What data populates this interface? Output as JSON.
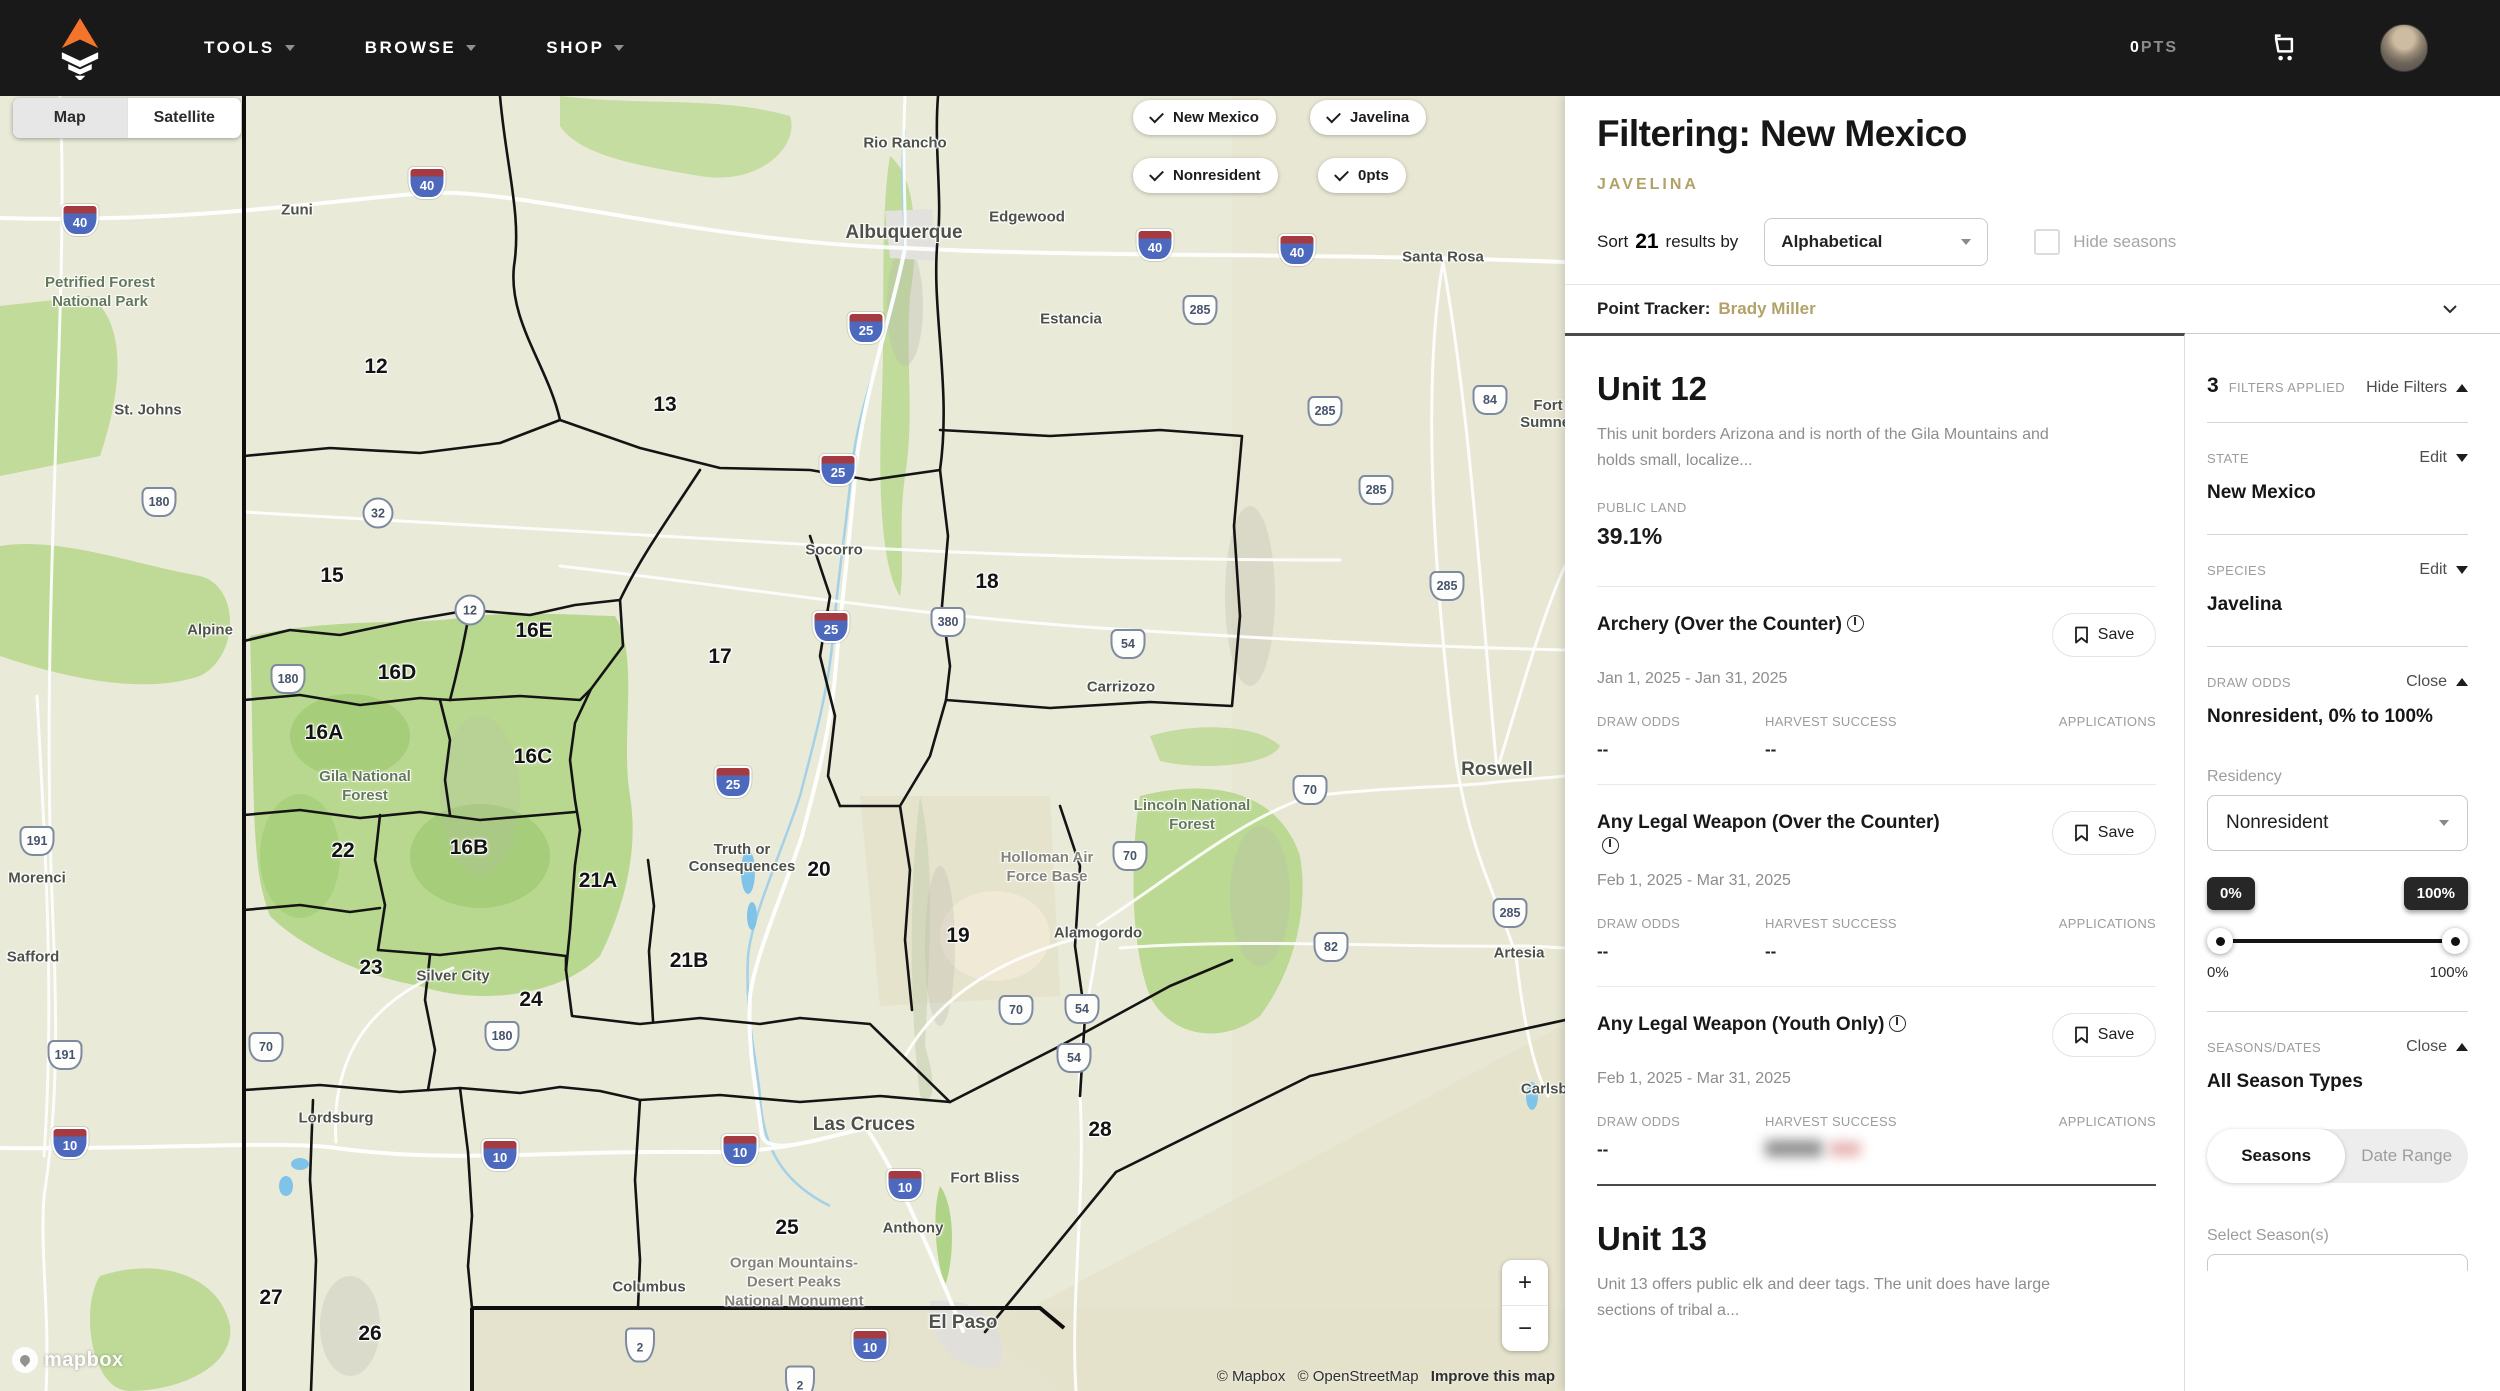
{
  "nav": {
    "menus": [
      {
        "label": "TOOLS"
      },
      {
        "label": "BROWSE"
      },
      {
        "label": "SHOP"
      }
    ],
    "points_value": "0",
    "points_label": "PTS"
  },
  "map": {
    "style_toggle": {
      "map": "Map",
      "satellite": "Satellite"
    },
    "chips": [
      {
        "label": "New Mexico"
      },
      {
        "label": "Javelina"
      },
      {
        "label": "Nonresident"
      },
      {
        "label": "0pts"
      }
    ],
    "zoom": {
      "in": "+",
      "out": "−"
    },
    "logo_text": "mapbox",
    "attribution": {
      "mapbox": "© Mapbox",
      "osm": "© OpenStreetMap",
      "improve": "Improve this map"
    },
    "cities": [
      {
        "label": "Zuni",
        "x": 297,
        "y": 114
      },
      {
        "label": "St. Johns",
        "x": 148,
        "y": 314
      },
      {
        "label": "Alpine",
        "x": 210,
        "y": 534
      },
      {
        "label": "Rio Rancho",
        "x": 905,
        "y": 47
      },
      {
        "label": "Albuquerque",
        "x": 904,
        "y": 137,
        "size": "lg"
      },
      {
        "label": "Edgewood",
        "x": 1027,
        "y": 121
      },
      {
        "label": "Estancia",
        "x": 1071,
        "y": 223
      },
      {
        "label": "Santa Rosa",
        "x": 1443,
        "y": 161
      },
      {
        "label": "Fort Sumner",
        "x": 1548,
        "y": 318
      },
      {
        "label": "Socorro",
        "x": 834,
        "y": 454
      },
      {
        "label": "Carrizozo",
        "x": 1121,
        "y": 591
      },
      {
        "label": "Roswell",
        "x": 1497,
        "y": 674,
        "size": "lg"
      },
      {
        "label": "Truth or\nConsequences",
        "x": 742,
        "y": 762
      },
      {
        "label": "Alamogordo",
        "x": 1098,
        "y": 837
      },
      {
        "label": "Artesia",
        "x": 1519,
        "y": 857
      },
      {
        "label": "Morenci",
        "x": 37,
        "y": 782
      },
      {
        "label": "Safford",
        "x": 33,
        "y": 861
      },
      {
        "label": "Silver City",
        "x": 453,
        "y": 880
      },
      {
        "label": "Lordsburg",
        "x": 336,
        "y": 1022
      },
      {
        "label": "Las Cruces",
        "x": 864,
        "y": 1029,
        "size": "lg"
      },
      {
        "label": "Fort Bliss",
        "x": 985,
        "y": 1082
      },
      {
        "label": "Anthony",
        "x": 913,
        "y": 1132
      },
      {
        "label": "Columbus",
        "x": 649,
        "y": 1191
      },
      {
        "label": "El Paso",
        "x": 963,
        "y": 1227,
        "size": "lg"
      },
      {
        "label": "Carlsbad",
        "x": 1553,
        "y": 993
      }
    ],
    "areas": [
      {
        "label": "Petrified Forest\nNational Park",
        "x": 100,
        "y": 196,
        "tone": "green"
      },
      {
        "label": "Gila National\nForest",
        "x": 365,
        "y": 690,
        "tone": "green"
      },
      {
        "label": "Lincoln National\nForest",
        "x": 1192,
        "y": 719,
        "tone": "green"
      },
      {
        "label": "Holloman Air\nForce Base",
        "x": 1047,
        "y": 771,
        "tone": "gray"
      },
      {
        "label": "Organ Mountains-\nDesert Peaks\nNational Monument",
        "x": 794,
        "y": 1186,
        "tone": "gray"
      }
    ],
    "units": [
      {
        "label": "12",
        "x": 376,
        "y": 271
      },
      {
        "label": "13",
        "x": 665,
        "y": 309
      },
      {
        "label": "15",
        "x": 332,
        "y": 480
      },
      {
        "label": "16E",
        "x": 534,
        "y": 535
      },
      {
        "label": "16D",
        "x": 397,
        "y": 577
      },
      {
        "label": "16A",
        "x": 324,
        "y": 637
      },
      {
        "label": "16C",
        "x": 533,
        "y": 661
      },
      {
        "label": "16B",
        "x": 469,
        "y": 752
      },
      {
        "label": "17",
        "x": 720,
        "y": 561
      },
      {
        "label": "18",
        "x": 987,
        "y": 486
      },
      {
        "label": "19",
        "x": 958,
        "y": 840
      },
      {
        "label": "20",
        "x": 819,
        "y": 774
      },
      {
        "label": "21A",
        "x": 598,
        "y": 785
      },
      {
        "label": "21B",
        "x": 689,
        "y": 865
      },
      {
        "label": "22",
        "x": 343,
        "y": 755
      },
      {
        "label": "23",
        "x": 371,
        "y": 872
      },
      {
        "label": "24",
        "x": 531,
        "y": 904
      },
      {
        "label": "25",
        "x": 787,
        "y": 1132
      },
      {
        "label": "26",
        "x": 370,
        "y": 1238
      },
      {
        "label": "27",
        "x": 271,
        "y": 1202
      },
      {
        "label": "28",
        "x": 1100,
        "y": 1034
      }
    ],
    "shields": [
      {
        "t": "i",
        "label": "40",
        "x": 427,
        "y": 87
      },
      {
        "t": "i",
        "label": "40",
        "x": 80,
        "y": 124
      },
      {
        "t": "i",
        "label": "40",
        "x": 1155,
        "y": 149
      },
      {
        "t": "i",
        "label": "40",
        "x": 1297,
        "y": 154
      },
      {
        "t": "i",
        "label": "25",
        "x": 866,
        "y": 232
      },
      {
        "t": "i",
        "label": "25",
        "x": 838,
        "y": 374
      },
      {
        "t": "i",
        "label": "25",
        "x": 831,
        "y": 531
      },
      {
        "t": "i",
        "label": "25",
        "x": 733,
        "y": 686
      },
      {
        "t": "i",
        "label": "10",
        "x": 70,
        "y": 1047
      },
      {
        "t": "i",
        "label": "10",
        "x": 500,
        "y": 1059
      },
      {
        "t": "i",
        "label": "10",
        "x": 740,
        "y": 1054
      },
      {
        "t": "i",
        "label": "10",
        "x": 905,
        "y": 1089
      },
      {
        "t": "i",
        "label": "10",
        "x": 870,
        "y": 1249
      },
      {
        "t": "us",
        "label": "285",
        "x": 1200,
        "y": 214
      },
      {
        "t": "us",
        "label": "285",
        "x": 1325,
        "y": 315
      },
      {
        "t": "us",
        "label": "285",
        "x": 1376,
        "y": 394
      },
      {
        "t": "us",
        "label": "285",
        "x": 1447,
        "y": 490
      },
      {
        "t": "us",
        "label": "285",
        "x": 1510,
        "y": 817
      },
      {
        "t": "us",
        "label": "84",
        "x": 1490,
        "y": 304
      },
      {
        "t": "us",
        "label": "380",
        "x": 948,
        "y": 526
      },
      {
        "t": "us",
        "label": "54",
        "x": 1128,
        "y": 548
      },
      {
        "t": "us",
        "label": "54",
        "x": 1082,
        "y": 913
      },
      {
        "t": "us",
        "label": "54",
        "x": 1074,
        "y": 962
      },
      {
        "t": "us",
        "label": "70",
        "x": 1310,
        "y": 694
      },
      {
        "t": "us",
        "label": "70",
        "x": 1130,
        "y": 760
      },
      {
        "t": "us",
        "label": "70",
        "x": 1016,
        "y": 914
      },
      {
        "t": "us",
        "label": "70",
        "x": 266,
        "y": 951
      },
      {
        "t": "us",
        "label": "82",
        "x": 1331,
        "y": 851
      },
      {
        "t": "us",
        "label": "191",
        "x": 37,
        "y": 745
      },
      {
        "t": "us",
        "label": "191",
        "x": 65,
        "y": 959
      },
      {
        "t": "us",
        "label": "180",
        "x": 159,
        "y": 406
      },
      {
        "t": "us",
        "label": "180",
        "x": 288,
        "y": 583
      },
      {
        "t": "us",
        "label": "180",
        "x": 502,
        "y": 940
      },
      {
        "t": "c",
        "label": "32",
        "x": 378,
        "y": 417
      },
      {
        "t": "c",
        "label": "12",
        "x": 470,
        "y": 514
      },
      {
        "t": "mx",
        "label": "2",
        "x": 640,
        "y": 1249
      },
      {
        "t": "mx",
        "label": "2",
        "x": 800,
        "y": 1287
      }
    ]
  },
  "panel": {
    "title": "Filtering: New Mexico",
    "species_tag": "JAVELINA",
    "sort": {
      "prefix": "Sort",
      "count": "21",
      "suffix": "results by",
      "selected": "Alphabetical",
      "hide_seasons": "Hide seasons"
    },
    "point_tracker": {
      "label": "Point Tracker:",
      "name": "Brady Miller"
    },
    "columns": {
      "draw_odds": "DRAW ODDS",
      "harvest": "HARVEST SUCCESS",
      "applications": "APPLICATIONS"
    },
    "save_label": "Save",
    "units": [
      {
        "title": "Unit 12",
        "description": "This unit borders Arizona and is north of the Gila Mountains and holds small, localize...",
        "public_land_label": "PUBLIC LAND",
        "public_land_value": "39.1%"
      },
      {
        "title": "Unit 13",
        "description": "Unit 13 offers public elk and deer tags. The unit does have large sections of tribal a..."
      }
    ],
    "seasons": [
      {
        "title": "Archery (Over the Counter)",
        "dates": "Jan 1, 2025 - Jan 31, 2025",
        "draw_odds": "--",
        "harvest": "--"
      },
      {
        "title": "Any Legal Weapon (Over the Counter)",
        "dates": "Feb 1, 2025 - Mar 31, 2025",
        "draw_odds": "--",
        "harvest": "--"
      },
      {
        "title": "Any Legal Weapon (Youth Only)",
        "dates": "Feb 1, 2025 - Mar 31, 2025",
        "draw_odds": "--"
      }
    ],
    "filters": {
      "count": "3",
      "count_label": "FILTERS APPLIED",
      "hide_label": "Hide Filters",
      "state": {
        "label": "STATE",
        "action": "Edit",
        "value": "New Mexico"
      },
      "species": {
        "label": "SPECIES",
        "action": "Edit",
        "value": "Javelina"
      },
      "draw_odds": {
        "label": "DRAW ODDS",
        "action": "Close",
        "value": "Nonresident, 0% to 100%",
        "residency_label": "Residency",
        "residency_value": "Nonresident",
        "min_badge": "0%",
        "max_badge": "100%",
        "min_label": "0%",
        "max_label": "100%"
      },
      "seasons_dates": {
        "label": "SEASONS/DATES",
        "action": "Close",
        "value": "All Season Types",
        "tab_seasons": "Seasons",
        "tab_range": "Date Range",
        "select_label": "Select Season(s)"
      }
    }
  }
}
